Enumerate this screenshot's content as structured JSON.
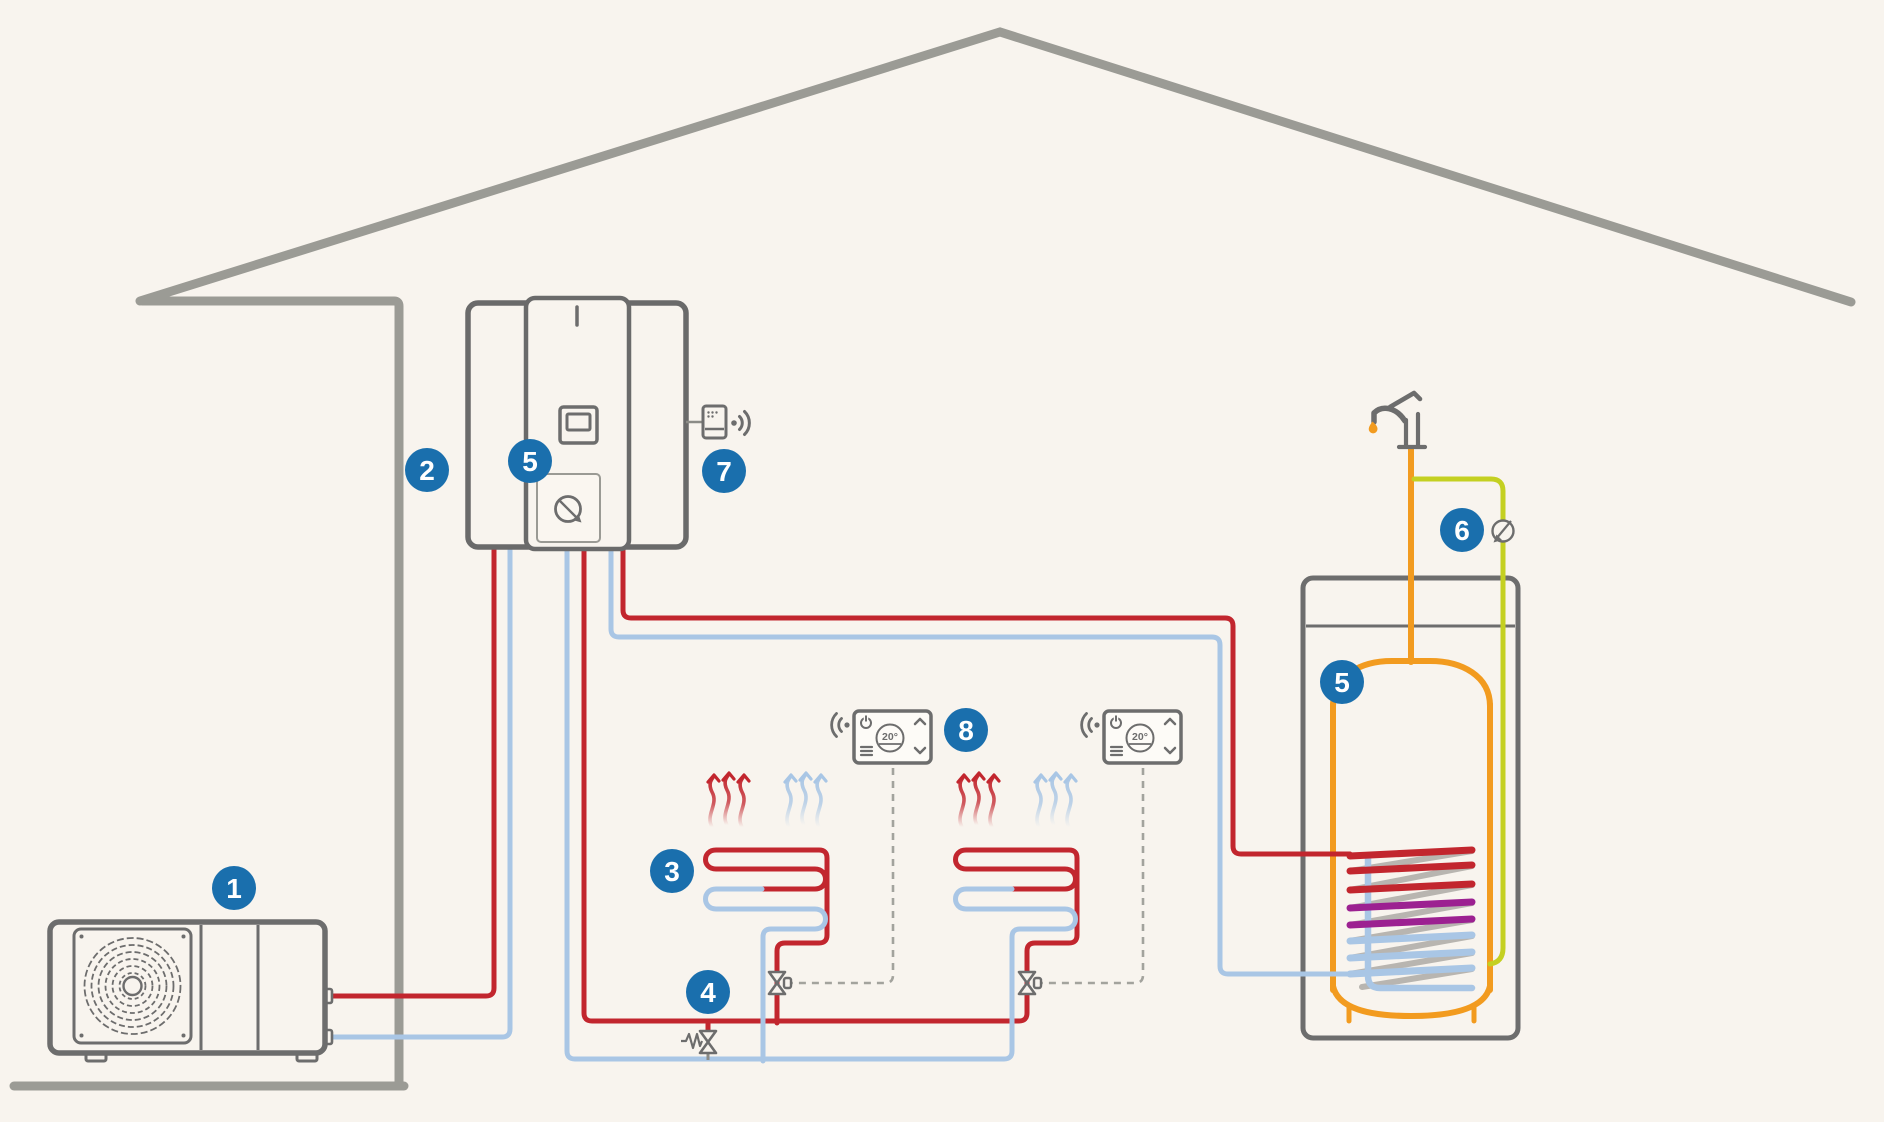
{
  "diagram": {
    "type": "heat-pump-heating-system-schematic",
    "callouts": {
      "outdoor_unit": "1",
      "line_set": "2",
      "underfloor_heating": "3",
      "bypass_valve": "4",
      "indoor_unit": "5",
      "hot_water_tank": "5",
      "cold_water_valve": "6",
      "wireless_gateway": "7",
      "room_thermostat": "8"
    },
    "thermostat": {
      "reading": "20°"
    },
    "colors": {
      "background": "#f8f4ee",
      "house_outline": "#9b9b95",
      "equipment_outline": "#6d6d6d",
      "hot_pipe": "#c2262e",
      "cold_pipe": "#a9c6e5",
      "tank_vessel": "#f29b1f",
      "cold_feed_pipe": "#c4d021",
      "coil_mid": "#9c2191",
      "coil_back": "#b8b5b0",
      "callout_badge": "#1a6fad"
    }
  }
}
